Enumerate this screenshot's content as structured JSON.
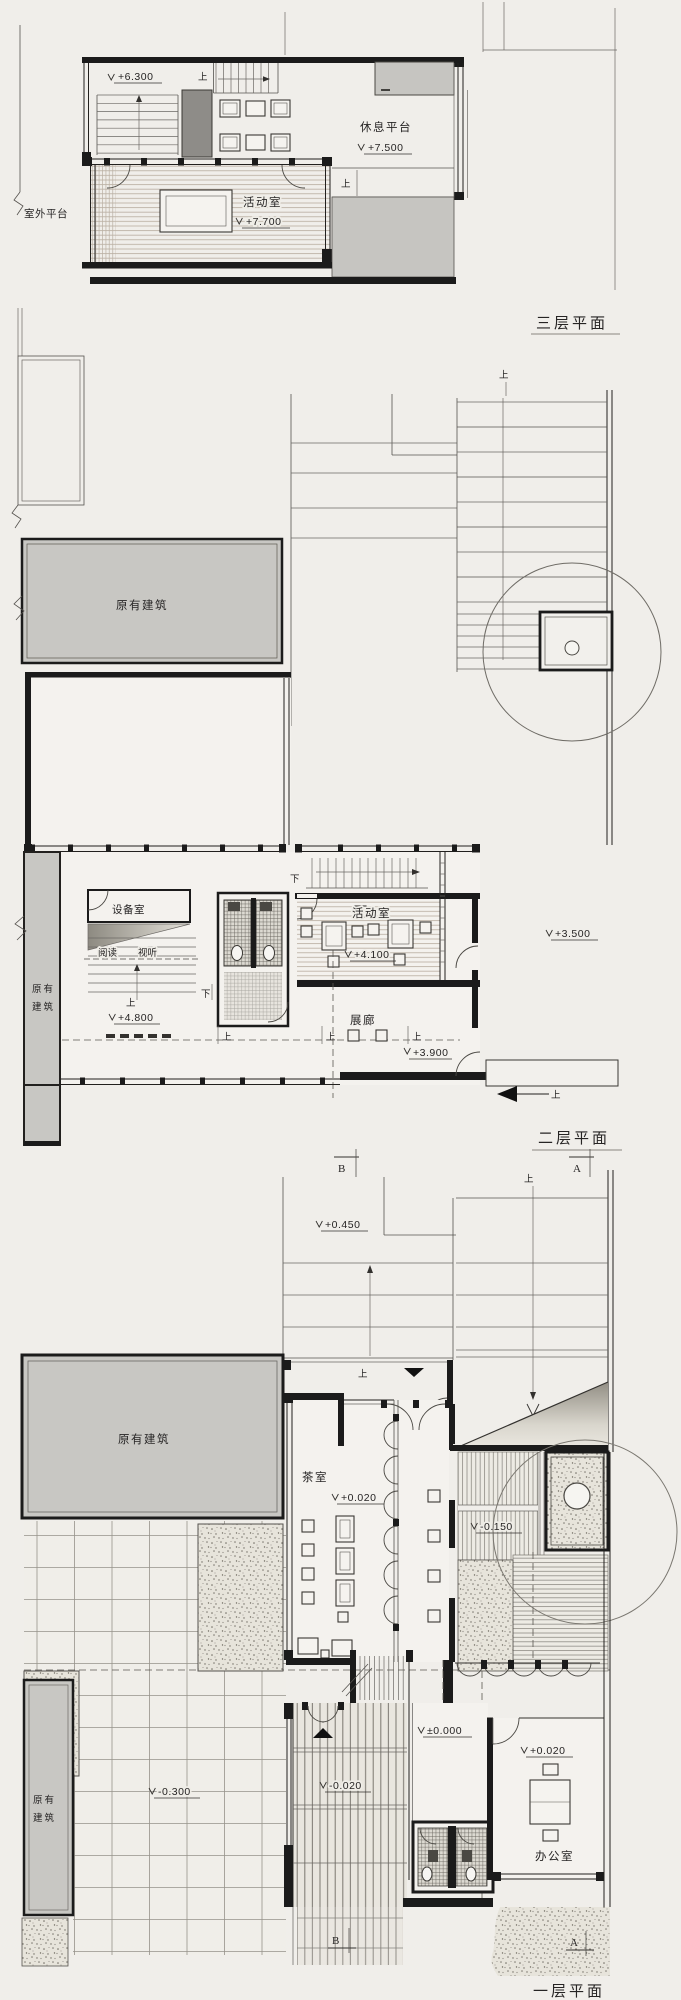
{
  "meta": {
    "sheet_bg": "#f0eeea",
    "ink": "#1b1b1b",
    "existing_fill": "#c8c7c3",
    "shaft_fill": "#8e8c88",
    "drawing_type": "hand-drawn architectural floor plans"
  },
  "floor3": {
    "title": "三层平面",
    "outdoor_platform": "室外平台",
    "level_6300": "+6.300",
    "up_stair": "上",
    "rest_platform": "休息平台",
    "level_7500": "+7.500",
    "up_terrace": "上",
    "activity_room": "活动室",
    "level_7700": "+7.700"
  },
  "floor2": {
    "title": "二层平面",
    "up_stair_top": "上",
    "existing_building": "原有建筑",
    "existing_side_1": "原有",
    "existing_side_2": "建筑",
    "equipment_room": "设备室",
    "reading": "阅读",
    "audio_visual": "视听",
    "down_stair": "下",
    "down_toilet": "下",
    "up_steps": "上",
    "activity_room": "活动室",
    "level_4100": "+4.100",
    "level_4800": "+4.800",
    "gallery": "展廊",
    "level_3900": "+3.900",
    "level_3500": "+3.500",
    "up_th1": "上",
    "up_th2": "上",
    "up_th3": "上",
    "up_entry": "上"
  },
  "floor1": {
    "title": "一层平面",
    "section_b_top": "B",
    "section_a_top": "A",
    "section_b_bottom": "B",
    "section_a_bottom": "A",
    "up_grid": "上",
    "level_0450": "+0.450",
    "up_landing": "上",
    "existing_building_top": "原有建筑",
    "existing_left_1": "原有",
    "existing_left_2": "建筑",
    "tea_room": "茶室",
    "level_tea": "+0.020",
    "level_deck": "-0.150",
    "level_court": "-0.300",
    "level_corridor": "-0.020",
    "level_hall": "±0.000",
    "level_office": "+0.020",
    "office": "办公室"
  }
}
